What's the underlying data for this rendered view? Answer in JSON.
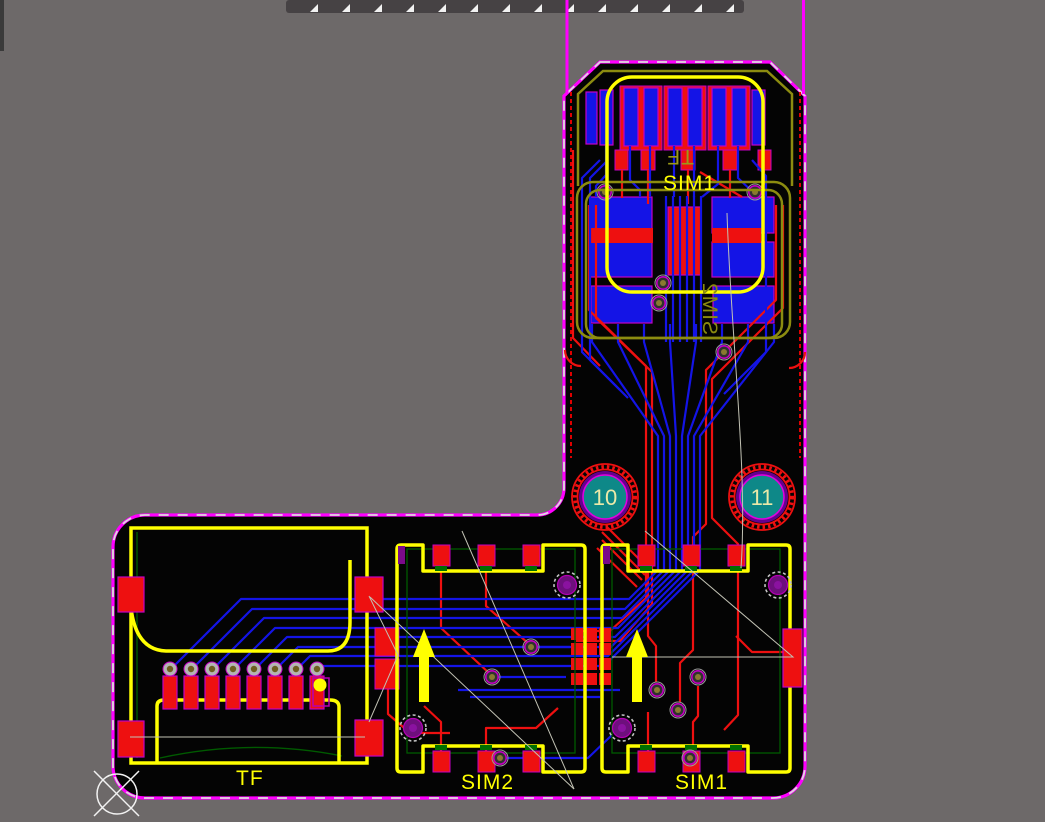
{
  "view": {
    "type": "pcb-layout-canvas",
    "background": "#6d6969",
    "board_fill": "#040404"
  },
  "colors": {
    "board_outline": "#ff00ff",
    "outline_dash": "#dedede",
    "silk_top": "#ffff00",
    "silk_bottom": "#8c8c10",
    "copper_top": "#ee1010",
    "copper_bottom": "#1414e6",
    "pad_border": "#c400c4",
    "keepout": "#e00000",
    "dark_green": "#005a00",
    "via_ring": "#b4b4b4",
    "via_core": "#8a7a30",
    "purple_via": "#6e0f7d",
    "hole_fill": "#0e8888",
    "hole_ring": "#66008e",
    "hole_text": "#ece9a8",
    "ratsnest": "#c2c2b4",
    "arrow": "#ffff00",
    "top_bar": "#464244",
    "notch": "#f2f2f2"
  },
  "labels": {
    "connector": "SIM1",
    "connector_mirrored": "TF",
    "sim2_mirrored": "SIM2",
    "tf_socket": "TF",
    "sim2_socket": "SIM2",
    "sim1_socket": "SIM1"
  },
  "holes": {
    "left": {
      "label": "10"
    },
    "right": {
      "label": "11"
    }
  }
}
